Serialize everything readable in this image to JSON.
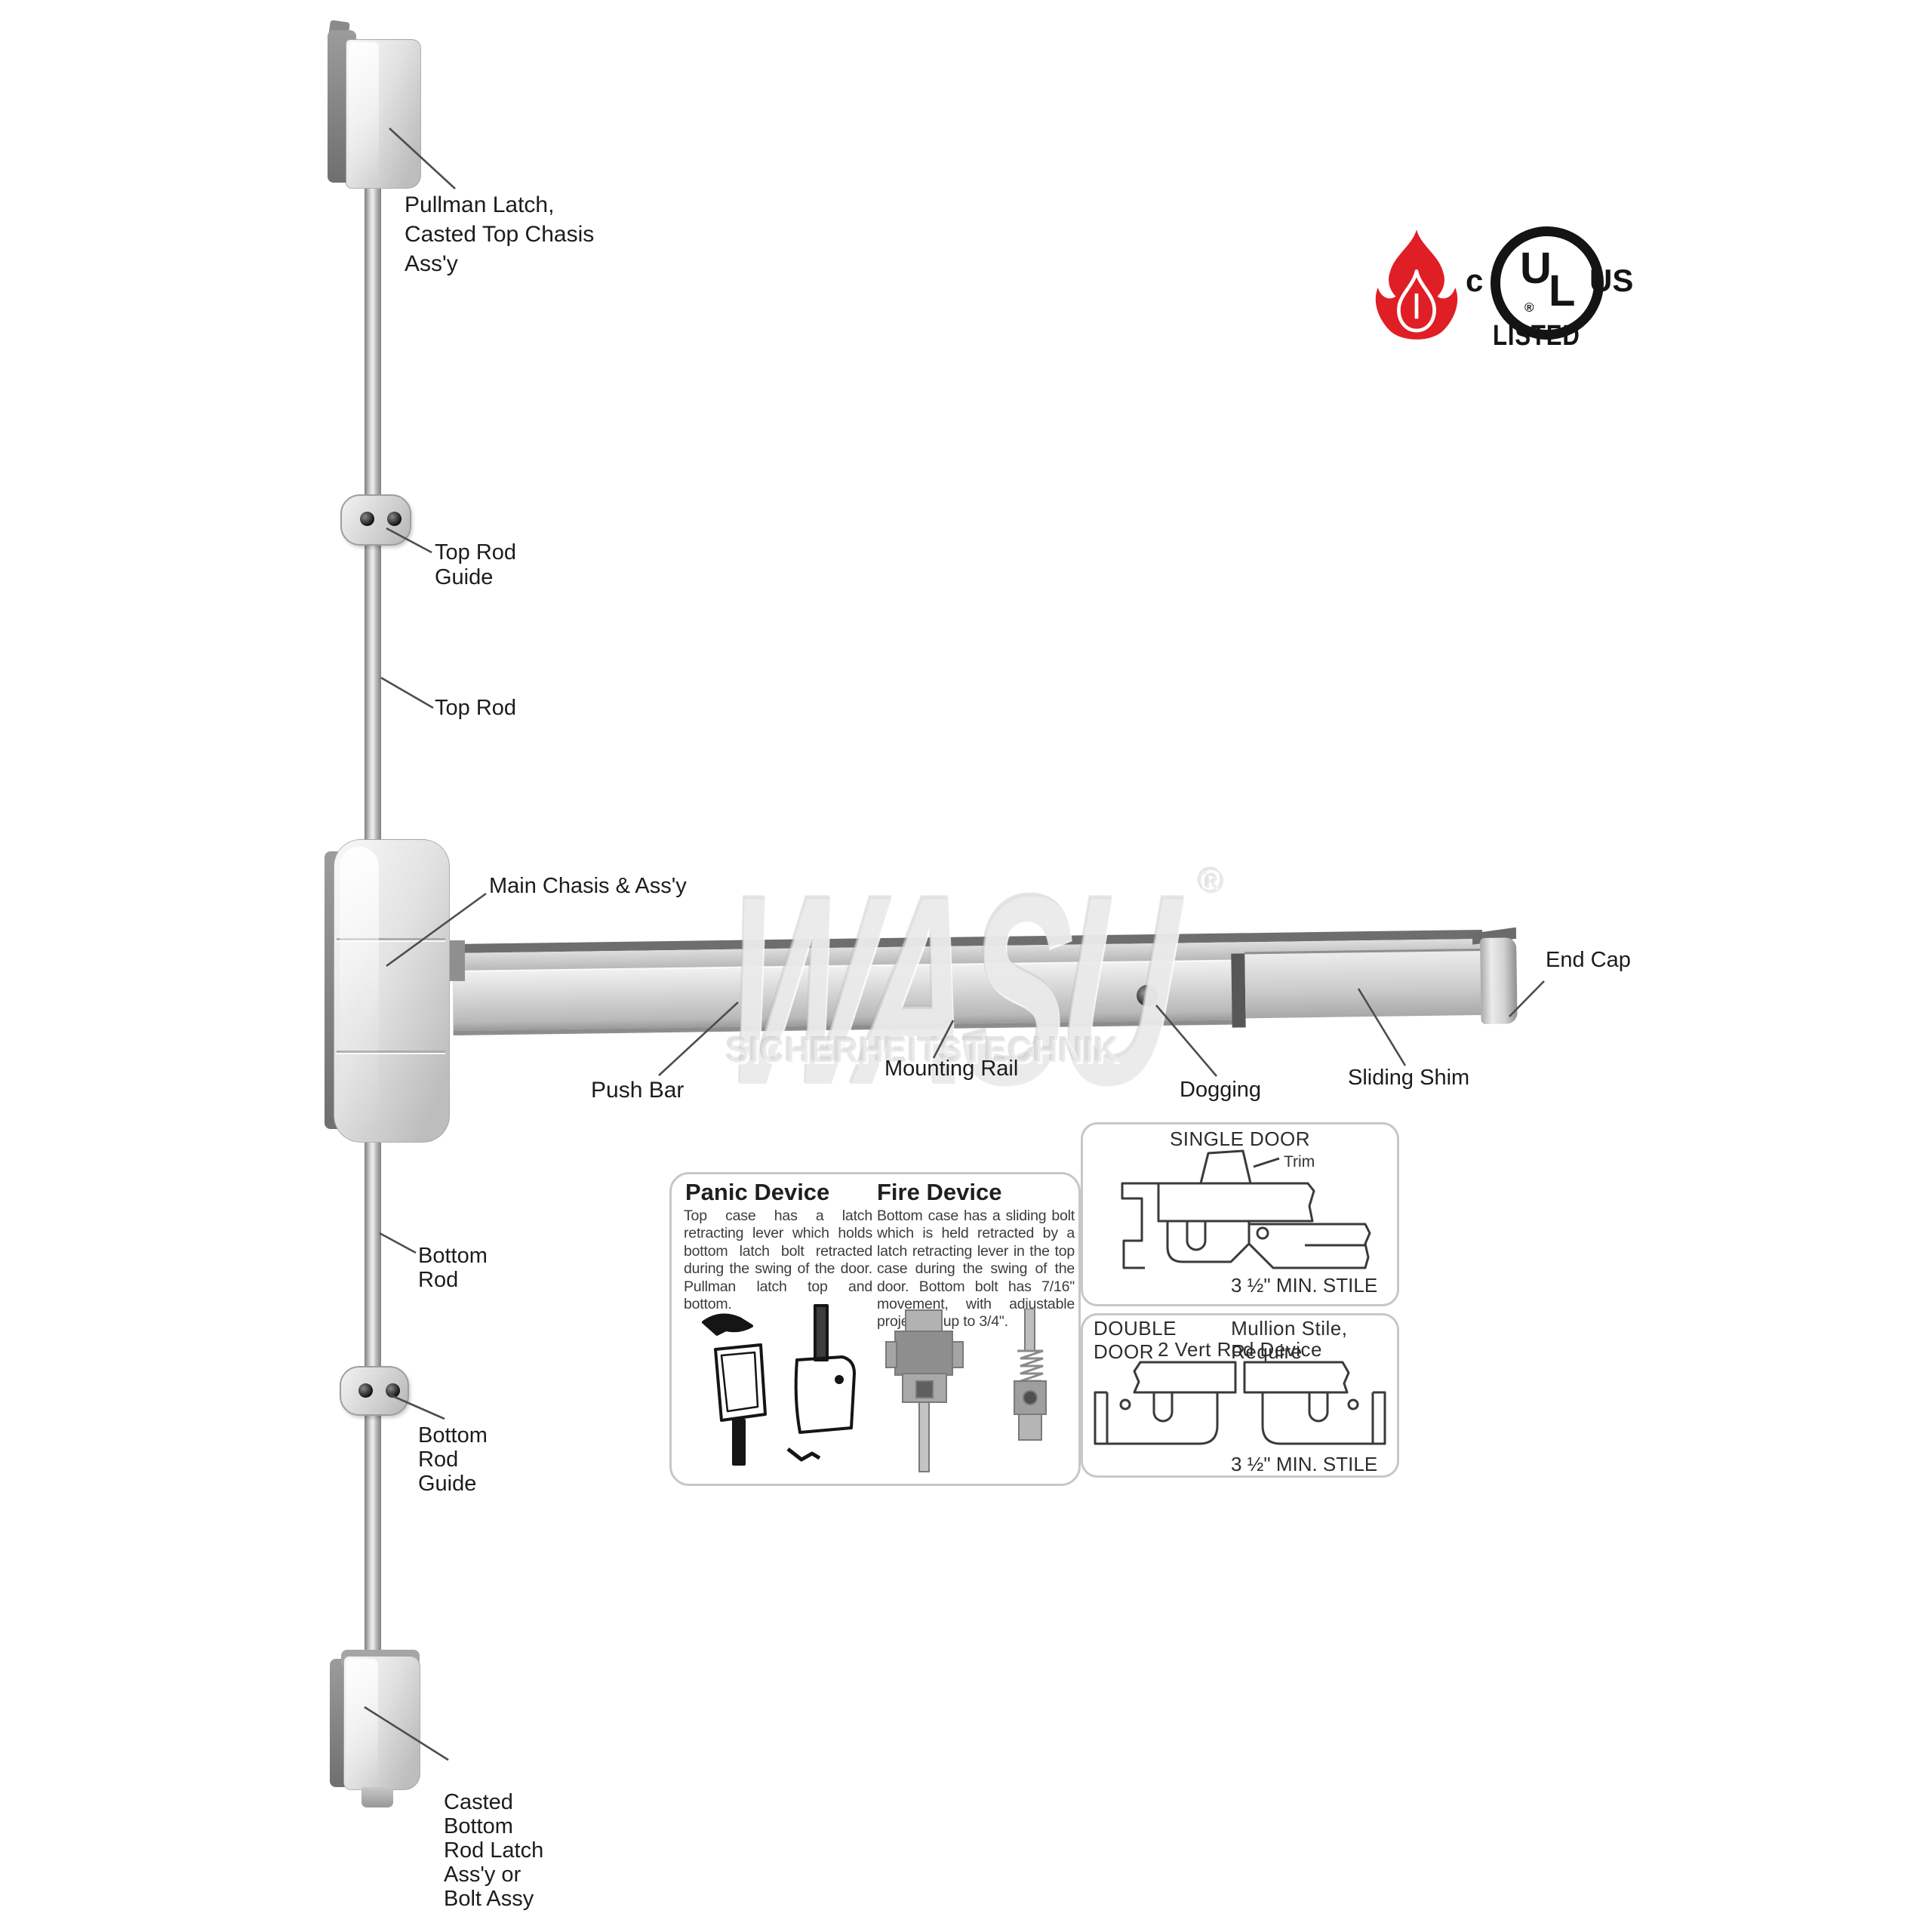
{
  "brand": {
    "watermark": "WASU",
    "watermark_reg": "®",
    "watermark_sub": "SICHERHEITSTECHNIK"
  },
  "certification": {
    "flame_icon": "fire-rated",
    "c": "c",
    "ul_u": "U",
    "ul_l": "L",
    "reg": "®",
    "us": "US",
    "listed": "LISTED",
    "flame_color": "#e01e25"
  },
  "parts": {
    "pullman": {
      "lines": [
        "Pullman Latch,",
        "Casted Top Chasis",
        "Ass'y"
      ]
    },
    "top_rod_guide": {
      "lines": [
        "Top Rod",
        "Guide"
      ]
    },
    "top_rod": {
      "lines": [
        "Top Rod"
      ]
    },
    "main_chasis": {
      "lines": [
        "Main Chasis & Ass'y"
      ]
    },
    "end_cap": {
      "lines": [
        "End Cap"
      ]
    },
    "push_bar": {
      "lines": [
        "Push Bar"
      ]
    },
    "mounting_rail": {
      "lines": [
        "Mounting Rail"
      ]
    },
    "dogging": {
      "lines": [
        "Dogging"
      ]
    },
    "sliding_shim": {
      "lines": [
        "Sliding Shim"
      ]
    },
    "bottom_rod": {
      "lines": [
        "Bottom",
        "Rod"
      ]
    },
    "bottom_rod_guide": {
      "lines": [
        "Bottom",
        "Rod",
        "Guide"
      ]
    },
    "bottom_latch": {
      "lines": [
        "Casted",
        "Bottom",
        "Rod Latch",
        "Ass'y or",
        "Bolt Assy"
      ]
    }
  },
  "info_box": {
    "panic": {
      "title": "Panic Device",
      "body": "Top case has a latch retracting lever which holds bottom latch bolt retracted during the swing of the door. Pullman latch top and bottom."
    },
    "fire": {
      "title": "Fire Device",
      "body": "Bottom case has a sliding bolt which is held retracted by a latch retracting lever in the top case during the swing of the door. Bottom bolt has 7/16\" movement, with adjustable projection up to 3/4\"."
    }
  },
  "door_boxes": {
    "single": {
      "title": "SINGLE DOOR",
      "trim_label": "Trim",
      "stile_note": "3 ½\" MIN. STILE"
    },
    "double": {
      "title": "DOUBLE DOOR",
      "subtitle": "Mullion Stile, Require",
      "subtitle2": "2 Vert Rod Device",
      "stile_note": "3 ½\" MIN. STILE"
    }
  },
  "colors": {
    "flame_red": "#e01e25",
    "label_text": "#1c1c1c",
    "metal_light": "#f0f0f0",
    "metal_mid": "#c7c7c7",
    "metal_dark": "#8b8b8b"
  }
}
